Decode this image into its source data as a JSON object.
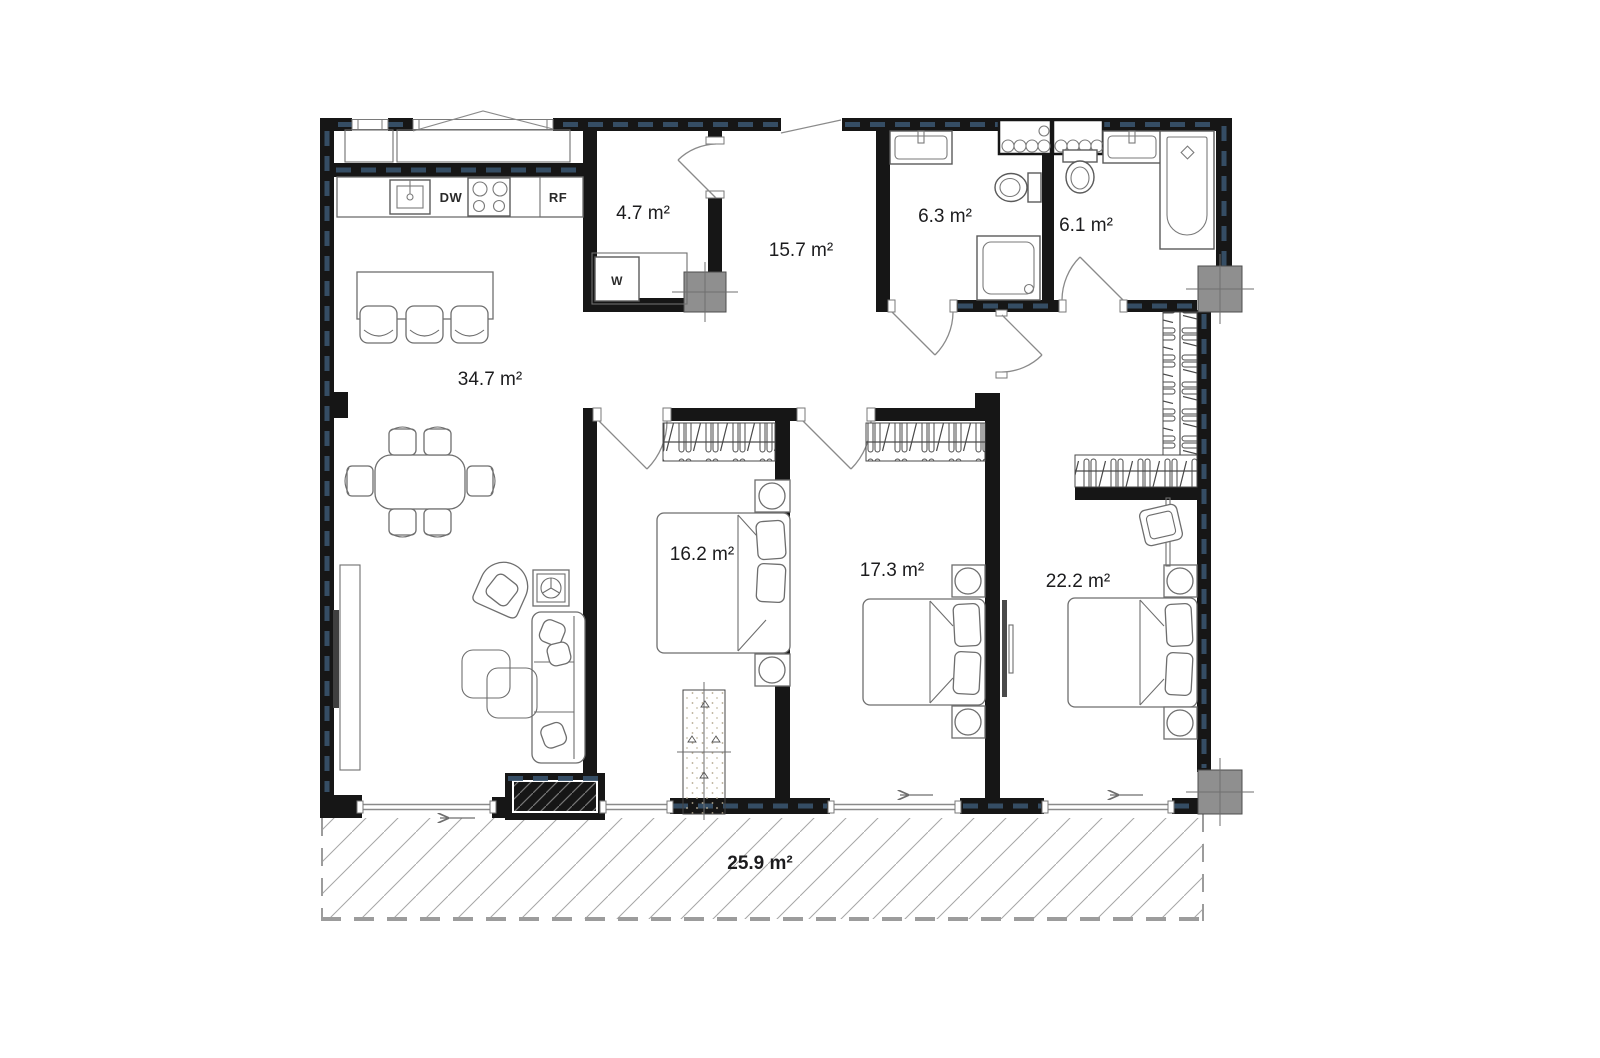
{
  "plan": {
    "type": "apartment-floor-plan",
    "rooms": [
      {
        "id": "living-kitchen",
        "label": "34.7 m²"
      },
      {
        "id": "entry-laundry",
        "label": "4.7 m²"
      },
      {
        "id": "hallway",
        "label": "15.7 m²"
      },
      {
        "id": "bathroom-1",
        "label": "6.3 m²"
      },
      {
        "id": "bathroom-2",
        "label": "6.1 m²"
      },
      {
        "id": "bedroom-1",
        "label": "16.2 m²"
      },
      {
        "id": "bedroom-2",
        "label": "17.3 m²"
      },
      {
        "id": "bedroom-3",
        "label": "22.2 m²"
      },
      {
        "id": "terrace",
        "label": "25.9 m²"
      }
    ],
    "appliances": {
      "dishwasher": "DW",
      "refrigerator": "RF",
      "washer": "W"
    },
    "colors": {
      "wall": "#161616",
      "insulation_dash": "#38536d",
      "furniture_line": "#6e6e6e",
      "column_fill": "#8f8f8f",
      "terrace_hatch": "#a6a6a6",
      "label_text": "#1c1c1e"
    }
  }
}
